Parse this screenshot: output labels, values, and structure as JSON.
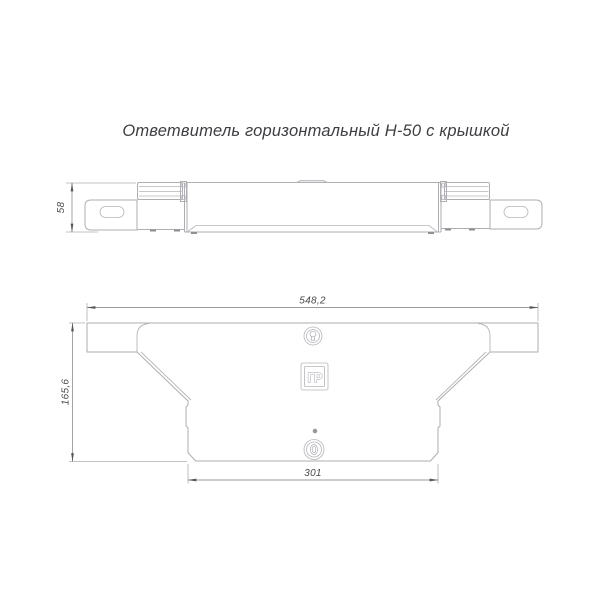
{
  "title": "Ответвитель горизонтальный Н-50 с крышкой",
  "drawing": {
    "type": "technical-drawing",
    "views": {
      "side_view": {
        "name": "side elevation view",
        "dimensions": {
          "height": "58"
        },
        "icons": [
          "hinge-icon",
          "flange-slot-icon"
        ]
      },
      "plan_view": {
        "name": "plan (top) view",
        "dimensions": {
          "overall_width": "548,2",
          "overall_depth": "165,6",
          "bottom_width": "301"
        },
        "icons": [
          "latch-keyhole-icon",
          "manufacturer-logo",
          "rivet-dot-icon"
        ],
        "logo_text": "ГР"
      }
    },
    "colors": {
      "background": "#ffffff",
      "line": "#aeaeb3",
      "dimension_line": "#9a9a9f",
      "text": "#4a4a4e",
      "title_text": "#3e3e42",
      "arrow": "#55555a"
    }
  }
}
